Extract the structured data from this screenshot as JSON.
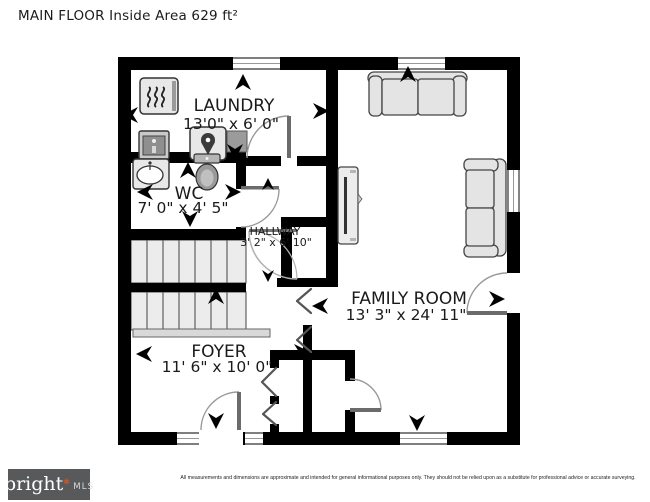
{
  "title": "MAIN FLOOR Inside Area 629 ft²",
  "rooms": {
    "laundry": {
      "name": "LAUNDRY",
      "dims": "13'0\" x 6' 0\""
    },
    "wc": {
      "name": "WC",
      "dims": "7' 0\" x 4' 5\""
    },
    "hallway": {
      "name": "HALLWAY",
      "dims": "3' 2\" x 6' 10\""
    },
    "family_room": {
      "name": "FAMILY ROOM",
      "dims": "13' 3\" x 24' 11\""
    },
    "foyer": {
      "name": "FOYER",
      "dims": "11' 6\" x 10' 0\""
    }
  },
  "icons": {
    "appliances": [
      "dryer-icon",
      "washer-icon",
      "water-heater-icon",
      "laundry-chute-icon"
    ],
    "fixtures": [
      "sink-icon",
      "toilet-icon"
    ],
    "furniture": [
      "sofa-icon",
      "loveseat-icon",
      "tv-unit-icon"
    ],
    "direction_arrows": [
      "arrow-up-icon",
      "arrow-down-icon",
      "arrow-left-icon",
      "arrow-right-icon"
    ]
  },
  "colors": {
    "wall": "#000000",
    "furniture_fill": "#e6e6e6",
    "stair_fill": "#ececec",
    "logo_bg": "#58595b",
    "logo_accent": "#c0562e",
    "door_arc": "#9a9a9a"
  },
  "footer": {
    "logo_primary": "bright",
    "logo_secondary": "MLS",
    "disclaimer": "All measurements and dimensions are approximate and intended for general informational purposes only. They should not be relied upon as a substitute for professional advice or accurate surveying."
  }
}
